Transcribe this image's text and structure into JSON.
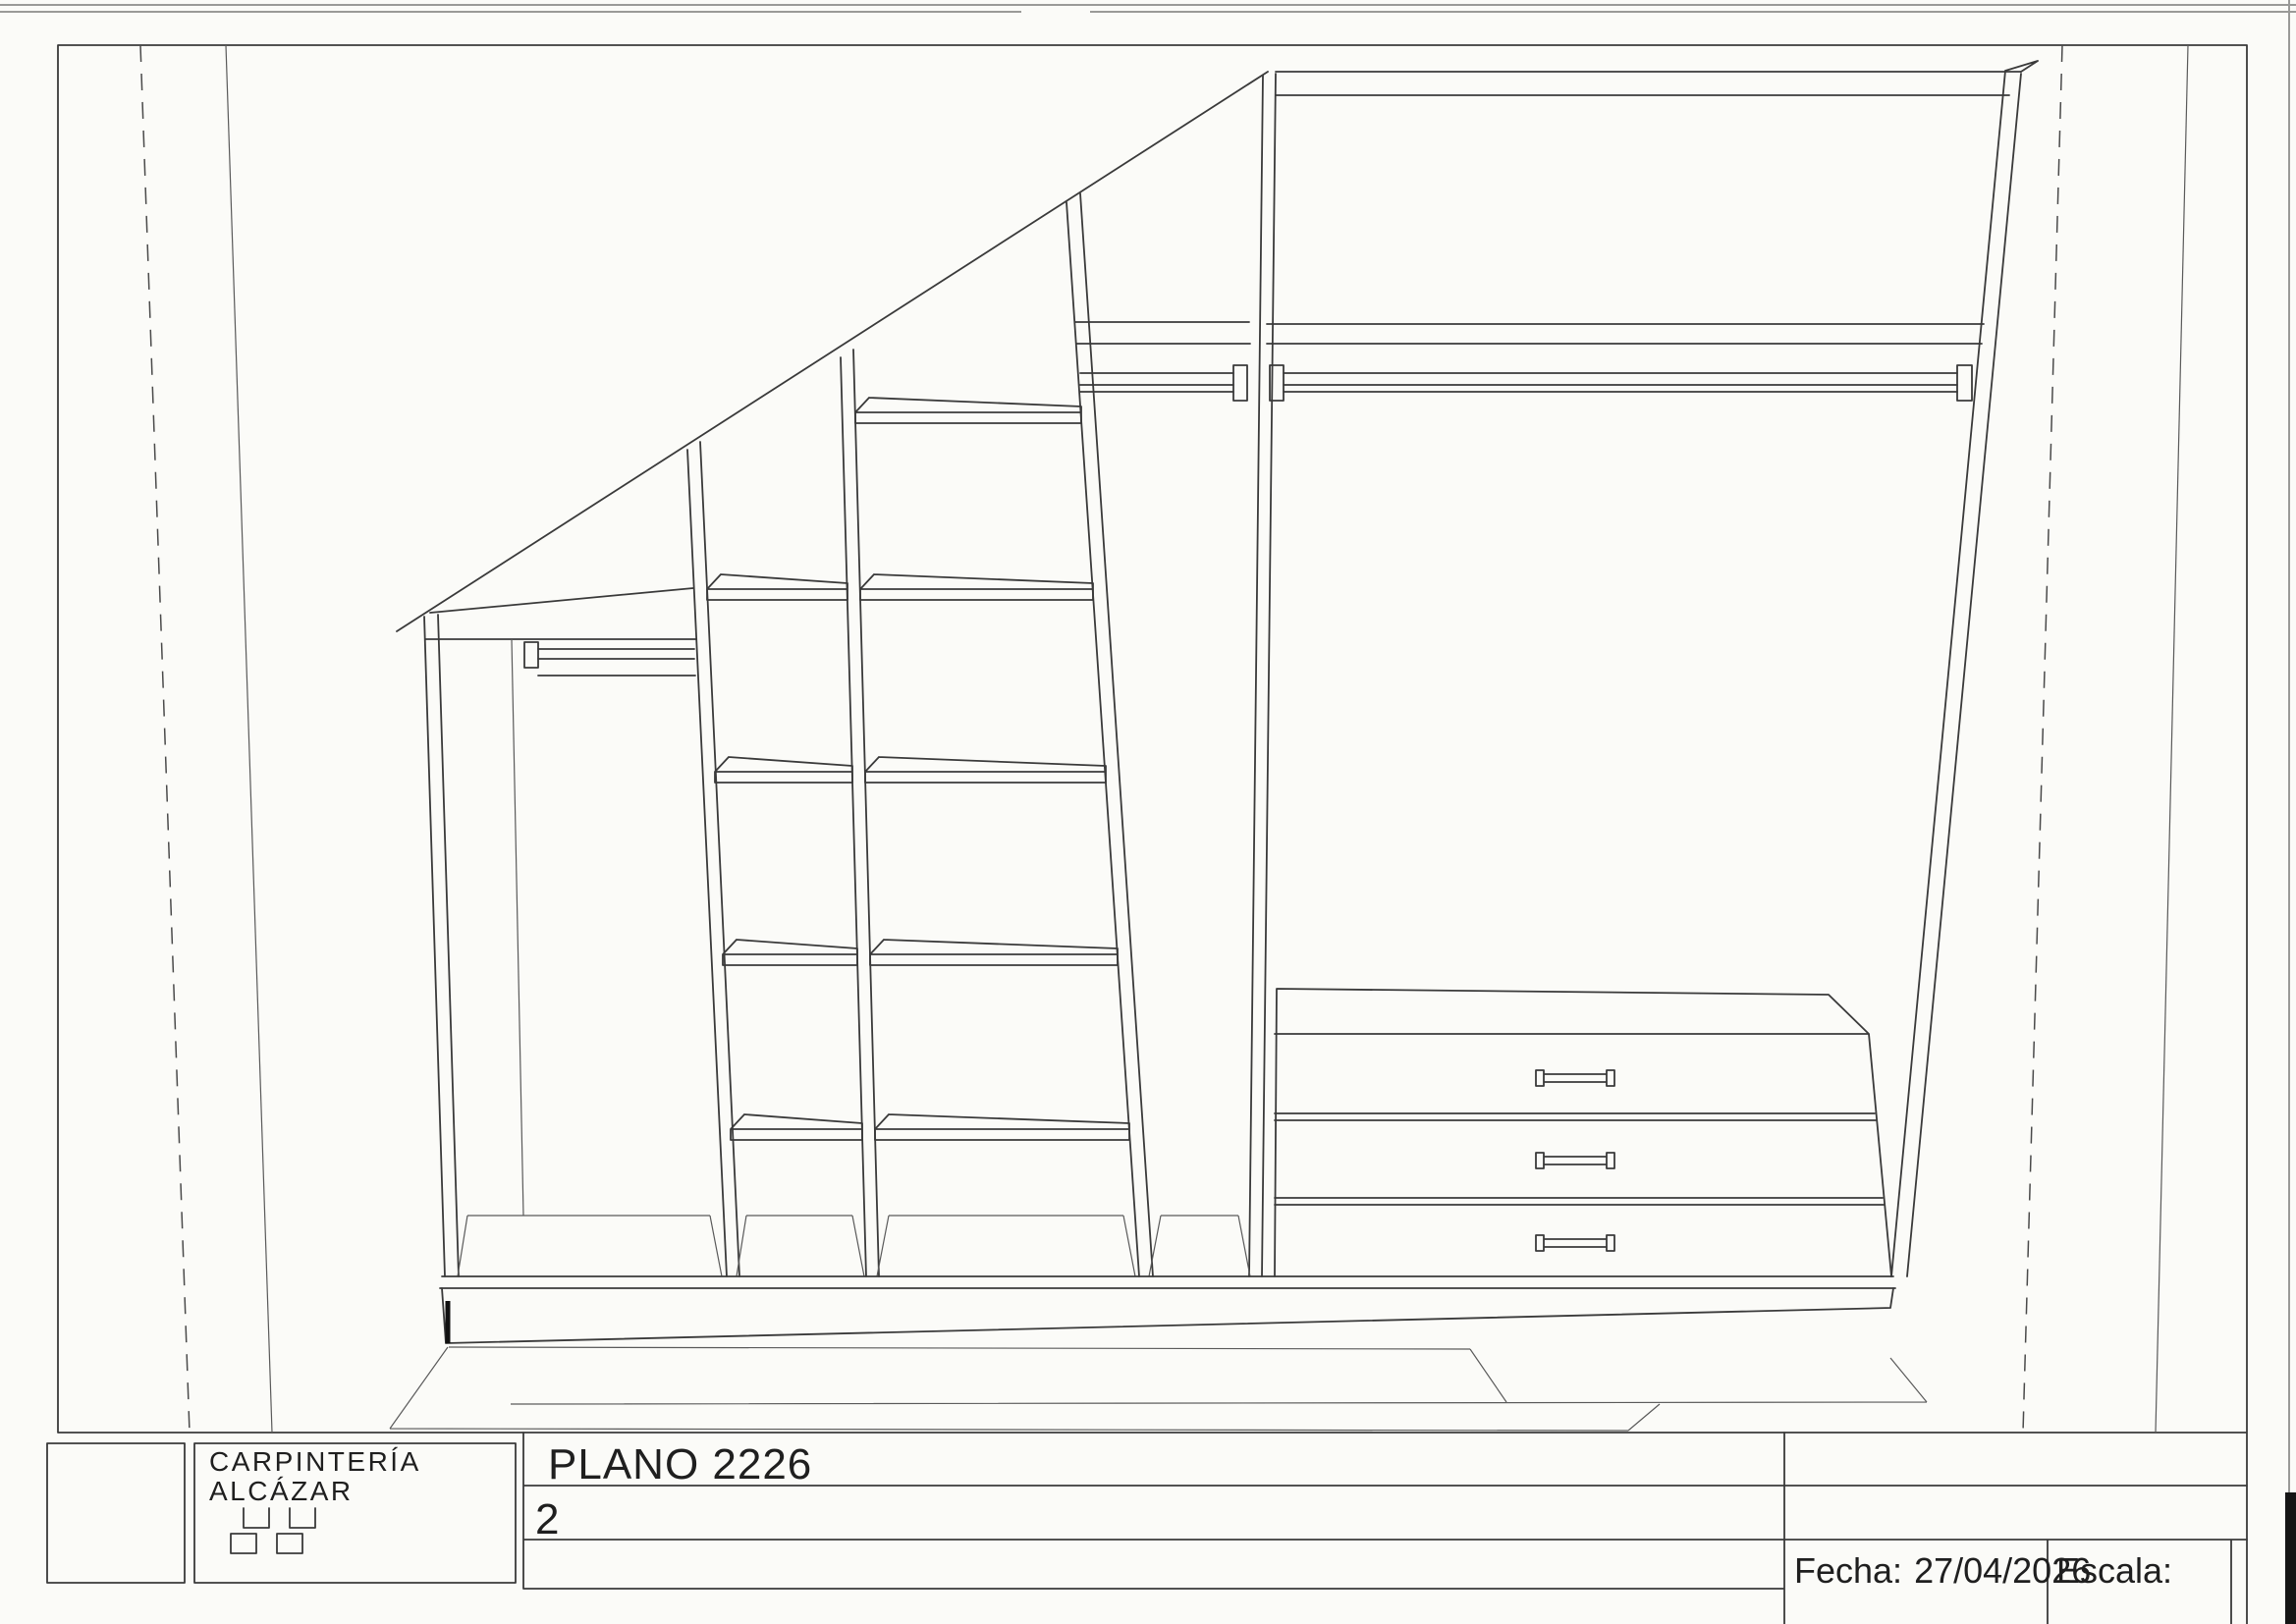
{
  "title_block": {
    "company_line1": "CARPINTERÍA",
    "company_line2": "ALCÁZAR",
    "plan_title": "PLANO 2226",
    "plan_number": "2",
    "date_label": "Fecha:",
    "date_value": "27/04/2026",
    "scale_label": "Escala:"
  },
  "drawing": {
    "type": "wardrobe interior elevation under sloped ceiling",
    "sections": 5,
    "shelf_columns": [
      {
        "shelves": 4
      },
      {
        "shelves": 5
      }
    ],
    "hanging_rods": 3,
    "drawers": 3
  },
  "colors": {
    "ink": "#3a3a3a",
    "paper": "#fbfbf8"
  }
}
